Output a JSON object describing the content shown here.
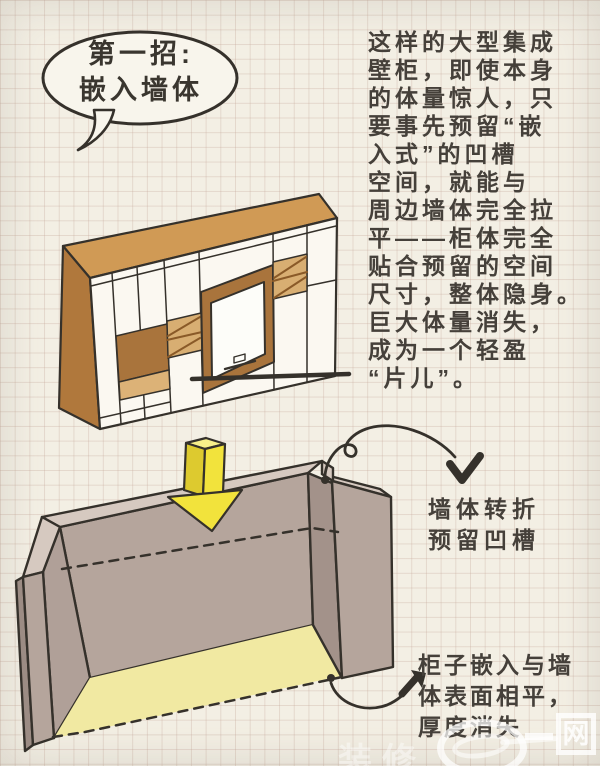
{
  "bubble": {
    "line1": "第一招:",
    "line2": "嵌入墙体"
  },
  "paragraph": {
    "lines": [
      "这样的大型集成",
      "壁柜，即使本身",
      "的体量惊人，只",
      "要事先预留“嵌",
      "入式”的凹槽",
      "空间，就能与",
      "周边墙体完全拉",
      "平——柜体完全",
      "贴合预留的空间",
      "尺寸，整体隐身。",
      "巨大体量消失，",
      "成为一个轻盈",
      "“片儿”。"
    ]
  },
  "annotations": {
    "wall_note": {
      "line1": "墙体转折",
      "line2": "预留凹槽"
    },
    "cabinet_note": {
      "line1": "柜子嵌入与墙",
      "line2": "体表面相平，",
      "line3": "厚度消失"
    }
  },
  "watermark": {
    "partial_text": "装修",
    "boxed_char": "网"
  },
  "illustrations": {
    "cabinet": "hand-drawn isometric built-in TV wall cabinet",
    "recess": "wall recess with yellow insert arrow, dashed cabinet outline, yellow floor"
  },
  "colors": {
    "paper": "#f3efe4",
    "ink": "#35312b",
    "cabinet_top": "#d09a55",
    "cabinet_side": "#b0783c",
    "cabinet_accent": "#a9743c",
    "shelf_tan": "#d8ae72",
    "wall_light": "#d6c9c0",
    "wall_mid": "#b5a59c",
    "wall_dark": "#a3928a",
    "arrow_yellow": "#f2e33c",
    "floor_yellow": "#f1e9a2"
  }
}
